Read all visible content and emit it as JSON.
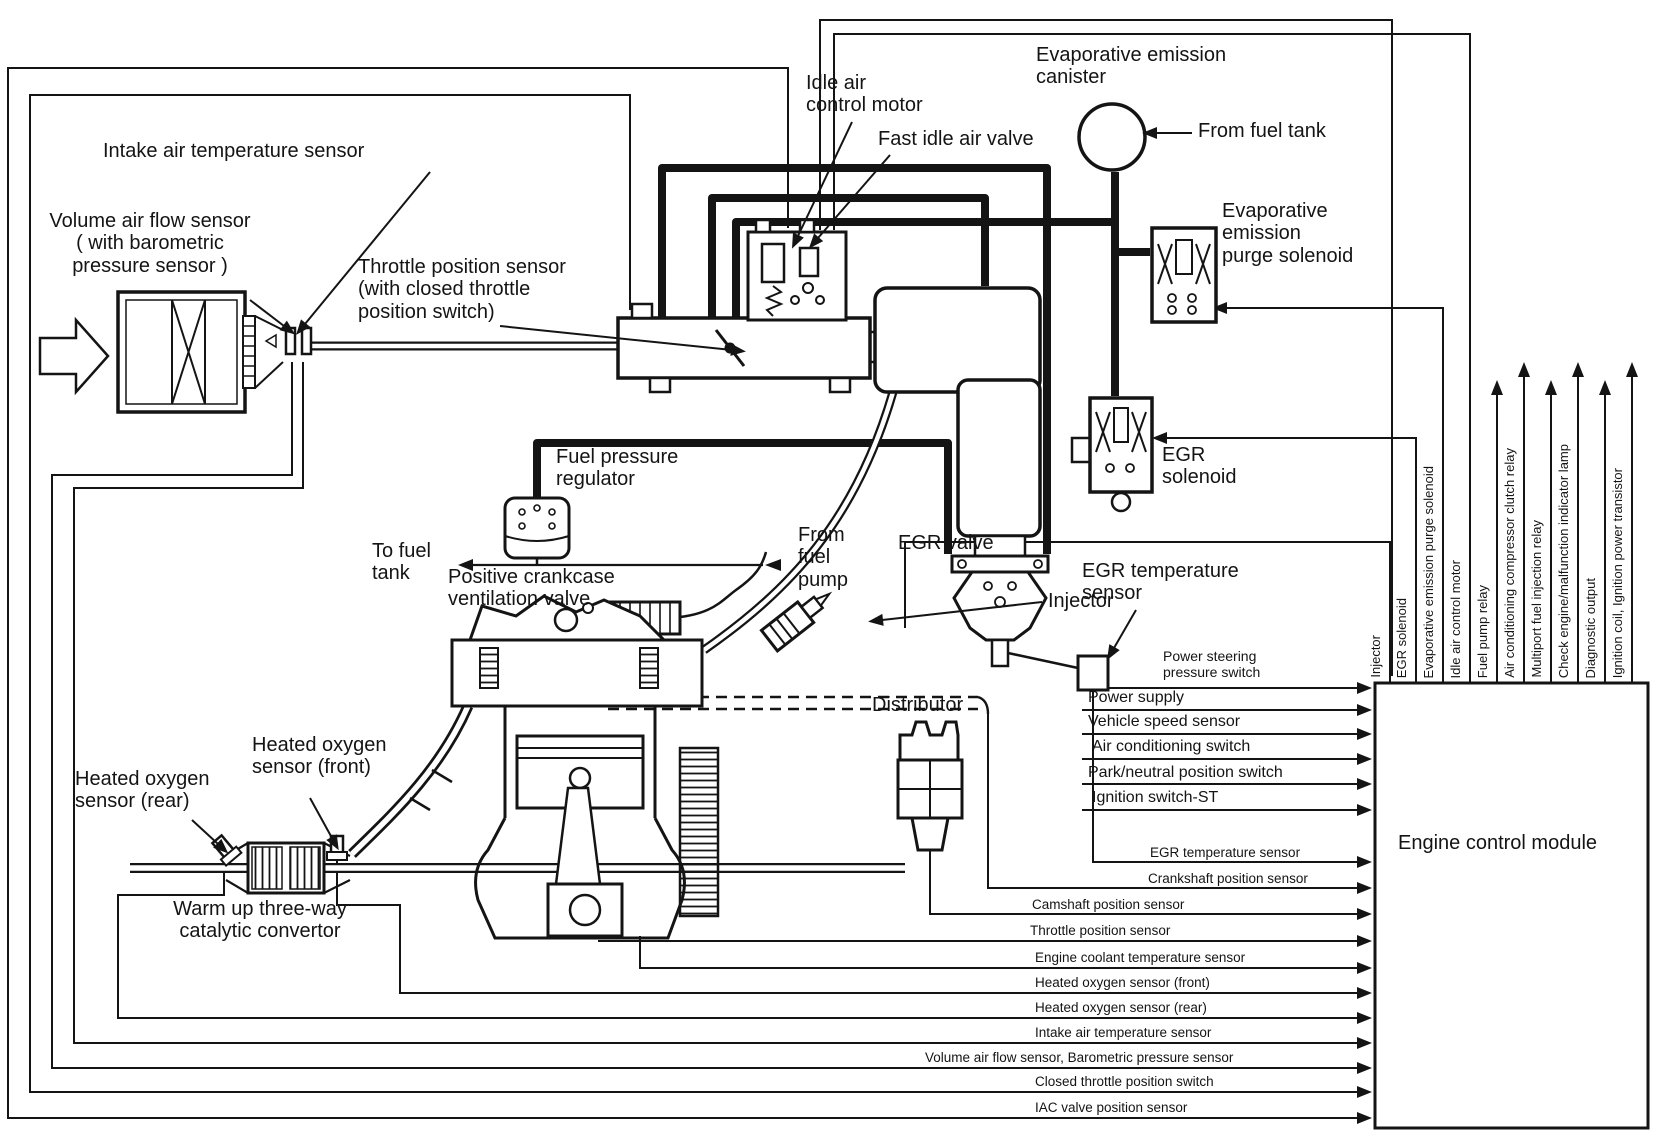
{
  "colors": {
    "ink": "#141414",
    "paper": "#ffffff"
  },
  "labels": {
    "intake_air_temp": [
      "Intake air temperature sensor"
    ],
    "volume_air_flow": [
      "Volume air flow sensor",
      "( with barometric",
      "pressure sensor )"
    ],
    "throttle_pos": [
      "Throttle position sensor",
      "(with closed throttle",
      "position switch)"
    ],
    "idle_air": [
      "Idle air",
      "control motor"
    ],
    "fast_idle": [
      "Fast idle air valve"
    ],
    "evap_canister": [
      "Evaporative emission",
      "canister"
    ],
    "from_fuel_tank": [
      "From fuel tank"
    ],
    "evap_purge": [
      "Evaporative",
      "emission",
      "purge solenoid"
    ],
    "egr_solenoid": [
      "EGR",
      "solenoid"
    ],
    "fuel_pressure_reg": [
      "Fuel pressure",
      "regulator"
    ],
    "to_fuel_tank": [
      "To fuel",
      "tank"
    ],
    "from_fuel_pump": [
      "From",
      "fuel",
      "pump"
    ],
    "pcv": [
      "Positive crankcase",
      "ventilation valve"
    ],
    "injector": [
      "Injector"
    ],
    "egr_valve": [
      "EGR valve"
    ],
    "egr_temp": [
      "EGR temperature",
      "sensor"
    ],
    "distributor": [
      "Distributor"
    ],
    "ho2_front": [
      "Heated oxygen",
      "sensor (front)"
    ],
    "ho2_rear": [
      "Heated oxygen",
      "sensor (rear)"
    ],
    "catalytic": [
      "Warm up three-way",
      "catalytic convertor"
    ]
  },
  "ecm": {
    "title": "Engine control module",
    "inputs": [
      {
        "lines": [
          "Power steering",
          "pressure switch"
        ]
      },
      {
        "label": "Power supply"
      },
      {
        "label": "Vehicle speed sensor"
      },
      {
        "label": "Air conditioning switch"
      },
      {
        "label": "Park/neutral position switch"
      },
      {
        "label": "Ignition switch-ST"
      },
      {
        "label": "EGR temperature sensor"
      },
      {
        "label": "Crankshaft position sensor"
      },
      {
        "label": "Camshaft position sensor"
      },
      {
        "label": "Throttle position sensor"
      },
      {
        "label": "Engine coolant temperature sensor"
      },
      {
        "label": "Heated oxygen sensor (front)"
      },
      {
        "label": "Heated oxygen sensor (rear)"
      },
      {
        "label": "Intake air temperature sensor"
      },
      {
        "label": "Volume air flow sensor, Barometric pressure sensor"
      },
      {
        "label": "Closed throttle position switch"
      },
      {
        "label": "IAC valve position sensor"
      }
    ],
    "top_io": [
      {
        "label": "Injector"
      },
      {
        "label": "EGR solenoid"
      },
      {
        "label": "Evaporative emission purge solenoid"
      },
      {
        "label": "Idle air control motor"
      },
      {
        "label": "Fuel pump relay"
      },
      {
        "label": "Air conditioning compressor clutch relay"
      },
      {
        "label": "Multiport fuel injection relay"
      },
      {
        "label": "Check engine/malfunction indicator lamp"
      },
      {
        "label": "Diagnostic output"
      },
      {
        "label": "Ignition coil, Ignition power transistor"
      }
    ]
  }
}
